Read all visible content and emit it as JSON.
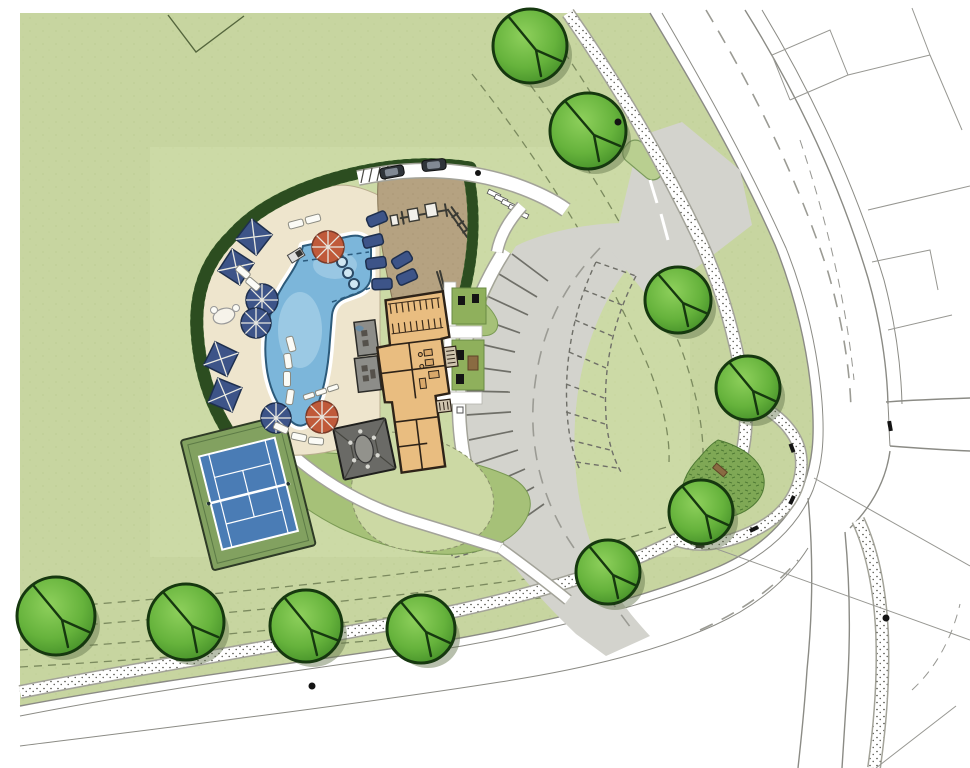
{
  "document": {
    "kind": "architectural-site-plan-rendering",
    "visible_text": "none"
  },
  "colors": {
    "paper": "#ffffff",
    "lawn": "#c7d5a0",
    "lawn_light": "#d3e0ac",
    "lawn_mound": "#a6c178",
    "mound_edge": "#7a9a54",
    "lawn_south": "#ccd9a4",
    "hedge": "#4b7339",
    "hedge_dark": "#2c4d20",
    "deck": "#eee5cd",
    "deck_edge": "#b9ad8e",
    "sand": "#b5a281",
    "sand_edge": "#847455",
    "water": "#7cb6da",
    "water_light": "#b5d8ec",
    "water_edge": "#2c5a7a",
    "coping": "#ffffff",
    "building": "#e9bd80",
    "wall": "#2e2318",
    "roof": "#8d8d89",
    "pavilion": "#6a6a66",
    "court_surround": "#82a160",
    "court_blue": "#4a7cb5",
    "court_line": "#ffffff",
    "umb_navy": "#3d5488",
    "umb_navy_dark": "#1e2f4e",
    "umb_orange": "#c05a3a",
    "umb_orange_dark": "#7a3a28",
    "lounger": "#fbfbf6",
    "parking": "#d3d3cd",
    "stall": "#6f6f68",
    "center_line": "#9b9b94",
    "road_line": "#8b8b85",
    "lot_line": "#979792",
    "walk_edge": "#a3a399",
    "easement": "#7b8a5e",
    "tree_light": "#8ed05c",
    "tree_mid": "#66b33c",
    "tree_dark": "#3b8523",
    "tree_outline": "#16380f",
    "tree_shadow": "#5f7046",
    "median": "#b9cf90",
    "garden": "#7fa855",
    "bench_wood": "#8a6b42",
    "car_body": "#2f343a",
    "car_glass": "#8f99a4",
    "black": "#141414"
  },
  "features": {
    "trees_rendered": 10,
    "pool_umbrellas_orange": 2,
    "pool_umbrellas_navy": 3,
    "shade_cabanas": 4,
    "spa_jets": 3,
    "tennis_courts": 1,
    "parked_cars": 2,
    "parking_stalls_striped": 13,
    "parking_stalls_future_dashed": 10,
    "light_pole_dots": 4,
    "benches_on_corner_path": 5
  }
}
